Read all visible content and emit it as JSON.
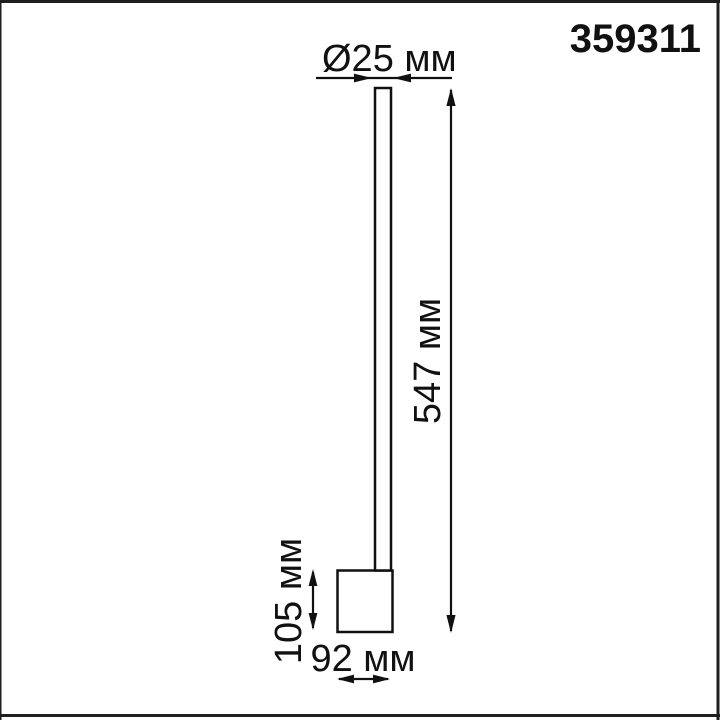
{
  "product_code": "359311",
  "diagram": {
    "labels": {
      "diameter": "Ø25 мм",
      "height": "547 мм",
      "base_height": "105 мм",
      "base_width": "92 мм"
    },
    "values": {
      "diameter_mm": 25,
      "height_mm": 547,
      "base_height_mm": 105,
      "base_width_mm": 92,
      "unit": "мм"
    },
    "parts": {
      "tube": "lamp-tube",
      "base": "lamp-base"
    }
  },
  "colors": {
    "line": "#111111",
    "background": "#ffffff",
    "frame": "#1f1f1f"
  }
}
